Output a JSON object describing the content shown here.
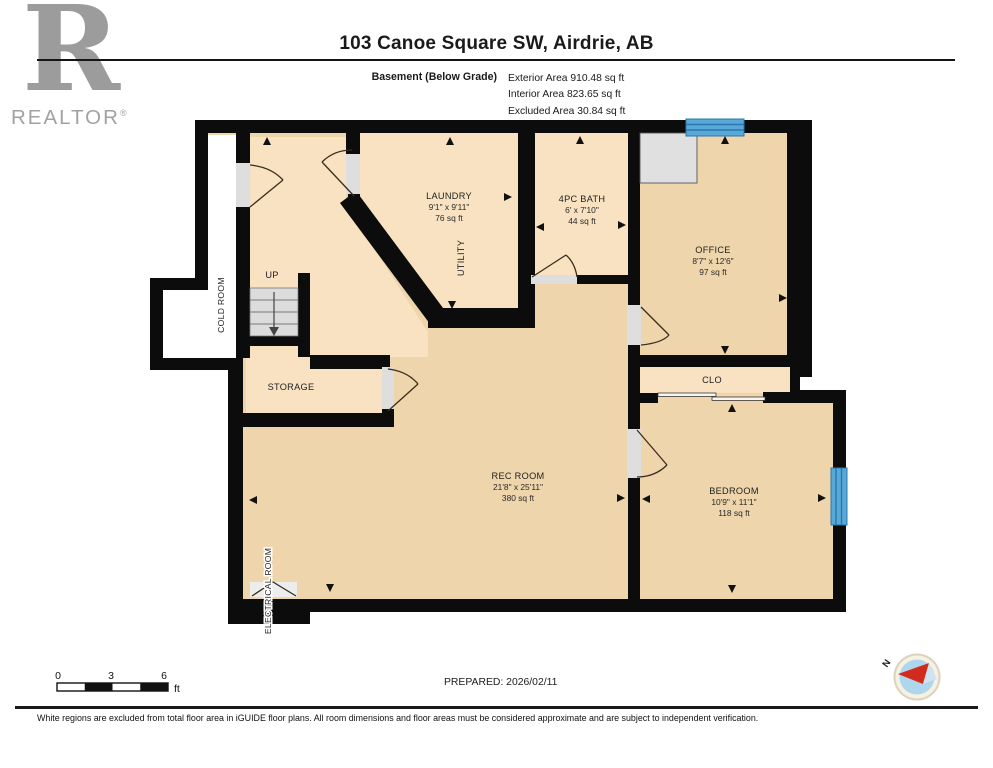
{
  "header": {
    "logo": {
      "letter": "R",
      "brand": "REALTOR",
      "registered": "®"
    },
    "title": "103 Canoe Square SW, Airdrie, AB",
    "floor_label": "Basement (Below Grade)",
    "area_lines": [
      "Exterior Area 910.48 sq ft",
      "Interior Area 823.65 sq ft",
      "Excluded Area 30.84 sq ft"
    ]
  },
  "plan": {
    "rooms": [
      {
        "name": "LAUNDRY",
        "dims": "9'1\" x 9'11\"",
        "area": "76 sq ft"
      },
      {
        "name": "UTILITY",
        "dims": "",
        "area": ""
      },
      {
        "name": "4PC BATH",
        "dims": "6' x 7'10\"",
        "area": "44 sq ft"
      },
      {
        "name": "OFFICE",
        "dims": "8'7\" x 12'6\"",
        "area": "97 sq ft"
      },
      {
        "name": "CLO",
        "dims": "",
        "area": ""
      },
      {
        "name": "BEDROOM",
        "dims": "10'9\" x 11'1\"",
        "area": "118 sq ft"
      },
      {
        "name": "REC ROOM",
        "dims": "21'8\" x 25'11\"",
        "area": "380 sq ft"
      },
      {
        "name": "STORAGE",
        "dims": "",
        "area": ""
      },
      {
        "name": "COLD ROOM",
        "dims": "",
        "area": ""
      },
      {
        "name": "ELECTRICAL ROOM",
        "dims": "",
        "area": ""
      }
    ],
    "stairs_up_label": "UP",
    "colors": {
      "wall": "#0c0c0c",
      "floor_light": "#f8e2c1",
      "floor_dark": "#eed5ab",
      "excluded": "#ffffff",
      "window_fill": "#58a9d7",
      "window_frame": "#2878ad",
      "door_opening": "#dedede",
      "stairs": "#dcdcdc"
    }
  },
  "footer": {
    "scale_ticks": [
      "0",
      "3",
      "6"
    ],
    "scale_unit": "ft",
    "prepared": "PREPARED: 2026/02/11",
    "compass_label": "N",
    "disclaimer": "White regions are excluded from total floor area in iGUIDE floor plans. All room dimensions and floor areas must be considered approximate and are subject to independent verification."
  }
}
